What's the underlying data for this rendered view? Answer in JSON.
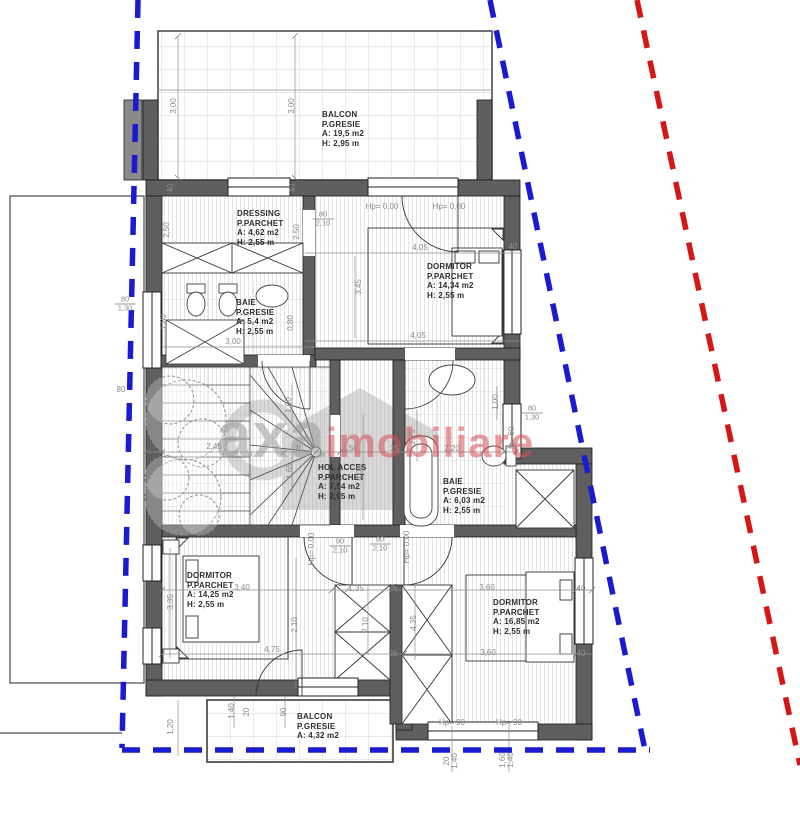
{
  "colors": {
    "boundary_blue": "#1a1ad0",
    "boundary_red": "#d41616",
    "wall_fill": "#5f5f5f",
    "dim_text": "#8a8a8a",
    "room_text": "#2e2e2e",
    "watermark_gray": "#9b9b9b",
    "watermark_red": "#d85057"
  },
  "watermark": {
    "brand": "axa",
    "suffix": "imobiliare"
  },
  "rooms": [
    {
      "id": "balcon-top",
      "x": 322,
      "y": 110,
      "lines": [
        "BALCON",
        "P.GRESIE",
        "A: 19,5 m2",
        "H: 2,95 m"
      ]
    },
    {
      "id": "dressing",
      "x": 237,
      "y": 209,
      "lines": [
        "DRESSING",
        "P.PARCHET",
        "A: 4,62 m2",
        "H: 2,55 m"
      ]
    },
    {
      "id": "dormitor-1",
      "x": 427,
      "y": 262,
      "lines": [
        "DORMITOR",
        "P.PARCHET",
        "A: 14,34 m2",
        "H: 2,55 m"
      ]
    },
    {
      "id": "baie-1",
      "x": 236,
      "y": 298,
      "lines": [
        "BAIE",
        "P.GRESIE",
        "A: 5,4 m2",
        "H: 2,55 m"
      ]
    },
    {
      "id": "hol-acces",
      "x": 318,
      "y": 463,
      "lines": [
        "HOL ACCES",
        "P.PARCHET",
        "A: 7,54 m2",
        "H: 2,95 m"
      ]
    },
    {
      "id": "baie-2",
      "x": 443,
      "y": 477,
      "lines": [
        "BAIE",
        "P.GRESIE",
        "A: 6,03 m2",
        "H: 2,55 m"
      ]
    },
    {
      "id": "dormitor-2",
      "x": 187,
      "y": 571,
      "lines": [
        "DORMITOR",
        "P.PARCHET",
        "A: 14,25 m2",
        "H: 2,55 m"
      ]
    },
    {
      "id": "dormitor-3",
      "x": 493,
      "y": 598,
      "lines": [
        "DORMITOR",
        "P.PARCHET",
        "A: 16,85 m2",
        "H: 2,55 m"
      ]
    },
    {
      "id": "balcon-bottom",
      "x": 297,
      "y": 712,
      "lines": [
        "BALCON",
        "P.GRESIE",
        "A: 4,32 m2"
      ]
    }
  ],
  "dim_labels": [
    {
      "t": "3,00",
      "x": 174,
      "y": 106,
      "r": -90
    },
    {
      "t": "3,00",
      "x": 292,
      "y": 106,
      "r": -90
    },
    {
      "t": "Hp= 0,00",
      "x": 382,
      "y": 207,
      "r": 0
    },
    {
      "t": "Hp= 0,00",
      "x": 449,
      "y": 207,
      "r": 0
    },
    {
      "t": "40",
      "x": 171,
      "y": 188,
      "r": -90
    },
    {
      "t": "40",
      "x": 293,
      "y": 188,
      "r": -90
    },
    {
      "t": "2,50",
      "x": 167,
      "y": 230,
      "r": -90
    },
    {
      "t": "2,50",
      "x": 297,
      "y": 232,
      "r": -90
    },
    {
      "t": "4,05",
      "x": 420,
      "y": 248,
      "r": 0
    },
    {
      "t": "40",
      "x": 513,
      "y": 247,
      "r": 0
    },
    {
      "t": "3,45",
      "x": 359,
      "y": 287,
      "r": -90
    },
    {
      "t": "4,05",
      "x": 418,
      "y": 336,
      "r": 0
    },
    {
      "t": "3,00",
      "x": 233,
      "y": 342,
      "r": 0
    },
    {
      "t": "1,80",
      "x": 164,
      "y": 322,
      "r": -90
    },
    {
      "t": "0,80",
      "x": 291,
      "y": 323,
      "r": -90
    },
    {
      "t": "80",
      "x": 121,
      "y": 390,
      "r": 0
    },
    {
      "t": "2,45",
      "x": 214,
      "y": 447,
      "r": 0
    },
    {
      "t": "70",
      "x": 299,
      "y": 449,
      "r": 0
    },
    {
      "t": "1,50",
      "x": 350,
      "y": 449,
      "r": 0
    },
    {
      "t": "25",
      "x": 395,
      "y": 449,
      "r": 0
    },
    {
      "t": "2,20",
      "x": 452,
      "y": 449,
      "r": 0
    },
    {
      "t": "40",
      "x": 512,
      "y": 447,
      "r": 0
    },
    {
      "t": "1,00",
      "x": 289,
      "y": 405,
      "r": -90
    },
    {
      "t": "1,65",
      "x": 290,
      "y": 471,
      "r": -90
    },
    {
      "t": "2,75",
      "x": 413,
      "y": 437,
      "r": -90
    },
    {
      "t": "4,00",
      "x": 360,
      "y": 473,
      "r": -90
    },
    {
      "t": "1,00",
      "x": 496,
      "y": 402,
      "r": -90
    },
    {
      "t": "60",
      "x": 512,
      "y": 431,
      "r": -90
    },
    {
      "t": "Hp= 0,00",
      "x": 312,
      "y": 549,
      "r": -90
    },
    {
      "t": "Hp= 0,00",
      "x": 407,
      "y": 547,
      "r": -90
    },
    {
      "t": "3,40",
      "x": 242,
      "y": 588,
      "r": 0
    },
    {
      "t": "1,35",
      "x": 356,
      "y": 589,
      "r": 0
    },
    {
      "t": "25",
      "x": 393,
      "y": 588,
      "r": 0
    },
    {
      "t": "3,60",
      "x": 487,
      "y": 588,
      "r": 0
    },
    {
      "t": "40",
      "x": 581,
      "y": 589,
      "r": 0
    },
    {
      "t": "3,35",
      "x": 171,
      "y": 602,
      "r": -90
    },
    {
      "t": "2,10",
      "x": 295,
      "y": 625,
      "r": -90
    },
    {
      "t": "2,10",
      "x": 366,
      "y": 625,
      "r": -90
    },
    {
      "t": "4,35",
      "x": 414,
      "y": 623,
      "r": -90
    },
    {
      "t": "4,75",
      "x": 272,
      "y": 650,
      "r": 0
    },
    {
      "t": "25",
      "x": 393,
      "y": 654,
      "r": 0
    },
    {
      "t": "3,60",
      "x": 488,
      "y": 653,
      "r": 0
    },
    {
      "t": "40",
      "x": 581,
      "y": 654,
      "r": 0
    },
    {
      "t": "1,20",
      "x": 171,
      "y": 727,
      "r": -90
    },
    {
      "t": "1,40",
      "x": 232,
      "y": 711,
      "r": -90
    },
    {
      "t": "20",
      "x": 247,
      "y": 712,
      "r": -90
    },
    {
      "t": "90",
      "x": 284,
      "y": 712,
      "r": -90
    },
    {
      "t": "Hp= 90",
      "x": 452,
      "y": 723,
      "r": 0
    },
    {
      "t": "Hp= 90",
      "x": 509,
      "y": 723,
      "r": 0
    },
    {
      "t": "20",
      "x": 447,
      "y": 761,
      "r": -90
    },
    {
      "t": "1,40",
      "x": 455,
      "y": 761,
      "r": -90
    },
    {
      "t": "1,60",
      "x": 503,
      "y": 760,
      "r": -90
    },
    {
      "t": "1,40",
      "x": 511,
      "y": 760,
      "r": -90
    }
  ],
  "fraction_labels": [
    {
      "top": "80",
      "bottom": "2,10",
      "x": 323,
      "y": 219
    },
    {
      "top": "80",
      "bottom": "1,30",
      "x": 125,
      "y": 304
    },
    {
      "top": "80",
      "bottom": "1,30",
      "x": 532,
      "y": 413
    },
    {
      "top": "90",
      "bottom": "2,10",
      "x": 340,
      "y": 546
    },
    {
      "top": "90",
      "bottom": "2,10",
      "x": 380,
      "y": 544
    }
  ]
}
